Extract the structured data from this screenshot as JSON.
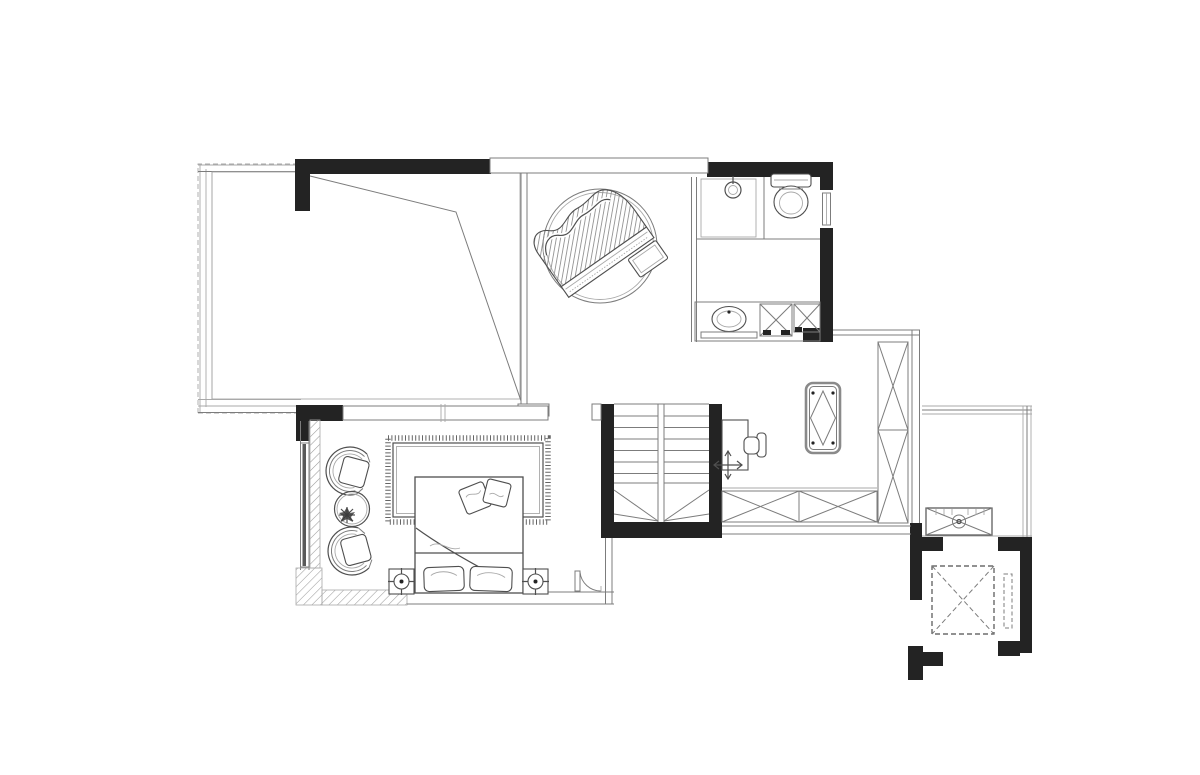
{
  "canvas": {
    "width": 1200,
    "height": 775,
    "background": "#ffffff"
  },
  "drawing": {
    "type": "residential floor plan, black-and-white architectural line drawing",
    "storey": "upper floor with stair, elevator shaft and sloped-roof terrace",
    "visible_text": []
  },
  "palette": {
    "paper": "#ffffff",
    "wall": "#232323",
    "line": "#7c7c7c",
    "line_dark": "#4f4f4f",
    "line_light": "#a9a9a9",
    "glass": "#5a5a5a"
  },
  "rooms": [
    {
      "id": "terrace",
      "position": "top-left",
      "fixtures": [
        "dashed railing walls",
        "sloped-roof valley lines"
      ]
    },
    {
      "id": "piano-room",
      "position": "top-center",
      "fixtures": [
        "round-rug",
        "grand-piano",
        "piano-bench"
      ]
    },
    {
      "id": "bathroom",
      "position": "top-right",
      "fixtures": [
        "shower-area",
        "floor-drain",
        "toilet",
        "window",
        "vanity-counter",
        "round-sink",
        "towel-bar",
        "x-cabinet",
        "x-cabinet"
      ]
    },
    {
      "id": "study-corridor",
      "position": "middle-right",
      "fixtures": [
        "desk",
        "desk-chair",
        "level-marker-cross",
        "console-table",
        "sideboard-cabinet-x2",
        "tall-wardrobe-x2"
      ]
    },
    {
      "id": "staircase",
      "position": "center",
      "fixtures": [
        "double-flight-stair",
        "winder-treads",
        "center-well"
      ]
    },
    {
      "id": "bedroom",
      "position": "bottom-left",
      "fixtures": [
        "armchair",
        "armchair",
        "round-side-table",
        "plant",
        "fringed-area-rug",
        "double-bed",
        "throw-pillow",
        "throw-pillow",
        "bed-pillow",
        "bed-pillow",
        "nightstand-with-lamp",
        "nightstand-with-lamp",
        "door-swing",
        "glazed-wall",
        "hatched-wall-band"
      ]
    },
    {
      "id": "balcony",
      "position": "right",
      "fixtures": [
        "ac-outdoor-unit"
      ]
    },
    {
      "id": "elevator-shaft",
      "position": "bottom-right",
      "fixtures": [
        "dashed-elevator-car",
        "dashed-counterweight"
      ]
    }
  ]
}
